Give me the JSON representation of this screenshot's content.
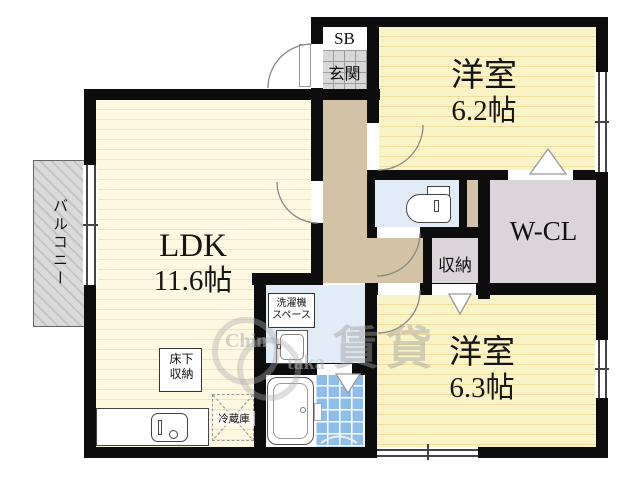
{
  "floorplan": {
    "balcony": {
      "label": "バルコニー"
    },
    "entrance": {
      "shoebox": "SB",
      "label": "玄関"
    },
    "rooms": {
      "ldk": {
        "name": "LDK",
        "size": "11.6帖"
      },
      "west1": {
        "name": "洋室",
        "size": "6.2帖"
      },
      "west2": {
        "name": "洋室",
        "size": "6.3帖"
      },
      "wcl": {
        "name": "W-CL"
      },
      "closet": {
        "name": "収納"
      }
    },
    "fixtures": {
      "underfloor": {
        "line1": "床下",
        "line2": "収納"
      },
      "fridge": {
        "label": "冷蔵庫"
      },
      "washer": {
        "line1": "洗濯機",
        "line2": "スペース"
      }
    },
    "watermark": {
      "kanji": "賃貸",
      "latin1": "Chin",
      "latin2": "taka"
    },
    "colors": {
      "wall": "#0d0d0d",
      "ldk_floor": "#fdf8e0",
      "room_floor": "#fbf3c8",
      "corridor": "#d3c2a5",
      "wet_floor": "#e2ecf6",
      "closet_floor": "#dbd5db",
      "bath_tile": "#8fbde9",
      "genkan_tile": "#d8d8d8",
      "balcony": "#dadada"
    }
  }
}
